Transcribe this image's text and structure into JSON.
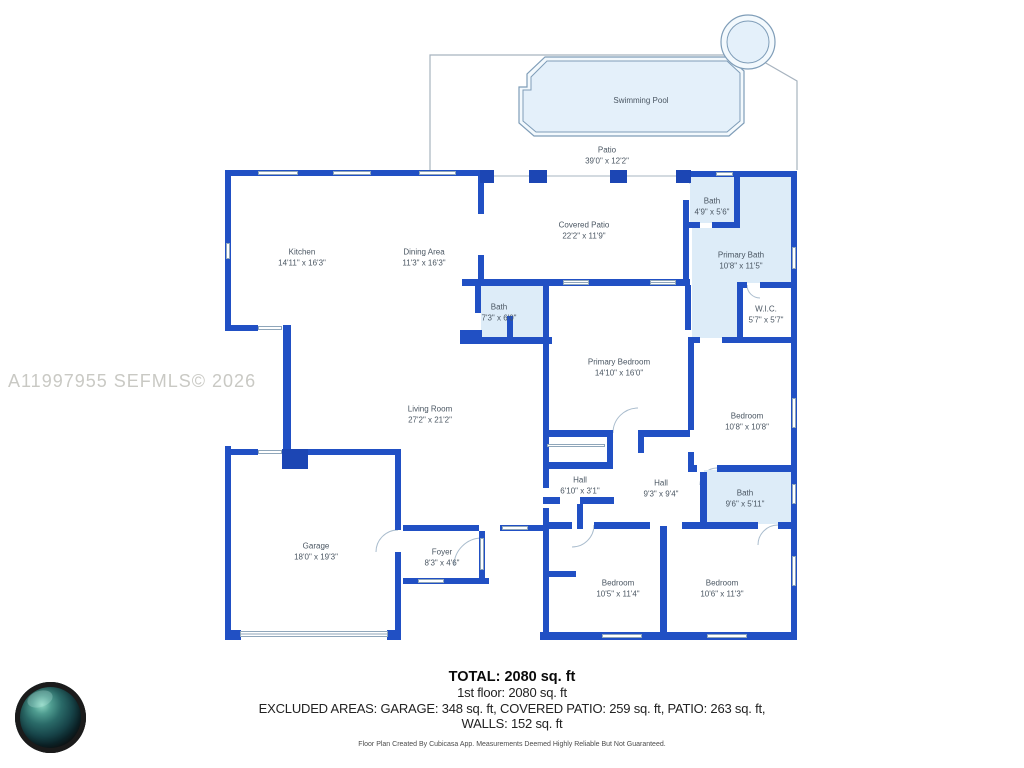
{
  "watermark": "A11997955 SEFMLS© 2026",
  "colors": {
    "wall_blue": "#2150c4",
    "dark_block_blue": "#1c46b4",
    "bath_fill": "#ddecf8",
    "pool_fill": "#e4f0fa",
    "outline_gray": "#9fb0bf",
    "label_text": "#4a5662"
  },
  "rooms": [
    {
      "id": "swimming-pool",
      "label": "Swimming Pool",
      "dims": ""
    },
    {
      "id": "patio",
      "label": "Patio",
      "dims": "39'0\" x 12'2\""
    },
    {
      "id": "kitchen",
      "label": "Kitchen",
      "dims": "14'11\" x 16'3\""
    },
    {
      "id": "dining-area",
      "label": "Dining Area",
      "dims": "11'3\" x 16'3\""
    },
    {
      "id": "covered-patio",
      "label": "Covered Patio",
      "dims": "22'2\" x 11'9\""
    },
    {
      "id": "bath-top",
      "label": "Bath",
      "dims": "4'9\" x 5'6\""
    },
    {
      "id": "primary-bath",
      "label": "Primary Bath",
      "dims": "10'8\" x 11'5\""
    },
    {
      "id": "wic",
      "label": "W.I.C.",
      "dims": "5'7\" x 5'7\""
    },
    {
      "id": "bath-middle",
      "label": "Bath",
      "dims": "7'3\" x 6'0\""
    },
    {
      "id": "primary-bedroom",
      "label": "Primary Bedroom",
      "dims": "14'10\" x 16'0\""
    },
    {
      "id": "bedroom-right",
      "label": "Bedroom",
      "dims": "10'8\" x 10'8\""
    },
    {
      "id": "living-room",
      "label": "Living Room",
      "dims": "27'2\" x 21'2\""
    },
    {
      "id": "hall-1",
      "label": "Hall",
      "dims": "6'10\" x 3'1\""
    },
    {
      "id": "hall-2",
      "label": "Hall",
      "dims": "9'3\" x 9'4\""
    },
    {
      "id": "bath-right",
      "label": "Bath",
      "dims": "9'6\" x 5'11\""
    },
    {
      "id": "garage",
      "label": "Garage",
      "dims": "18'0\" x 19'3\""
    },
    {
      "id": "foyer",
      "label": "Foyer",
      "dims": "8'3\" x 4'6\""
    },
    {
      "id": "bedroom-bottom-left",
      "label": "Bedroom",
      "dims": "10'5\" x 11'4\""
    },
    {
      "id": "bedroom-bottom-right",
      "label": "Bedroom",
      "dims": "10'6\" x 11'3\""
    }
  ],
  "footer": {
    "total": "TOTAL: 2080 sq. ft",
    "floor": "1st floor: 2080 sq. ft",
    "excluded_line1": "EXCLUDED AREAS: GARAGE: 348 sq. ft, COVERED PATIO: 259 sq. ft, PATIO: 263 sq. ft,",
    "excluded_line2": "WALLS: 152 sq. ft",
    "disclaimer": "Floor Plan Created By Cubicasa App. Measurements Deemed Highly Reliable But Not Guaranteed."
  }
}
